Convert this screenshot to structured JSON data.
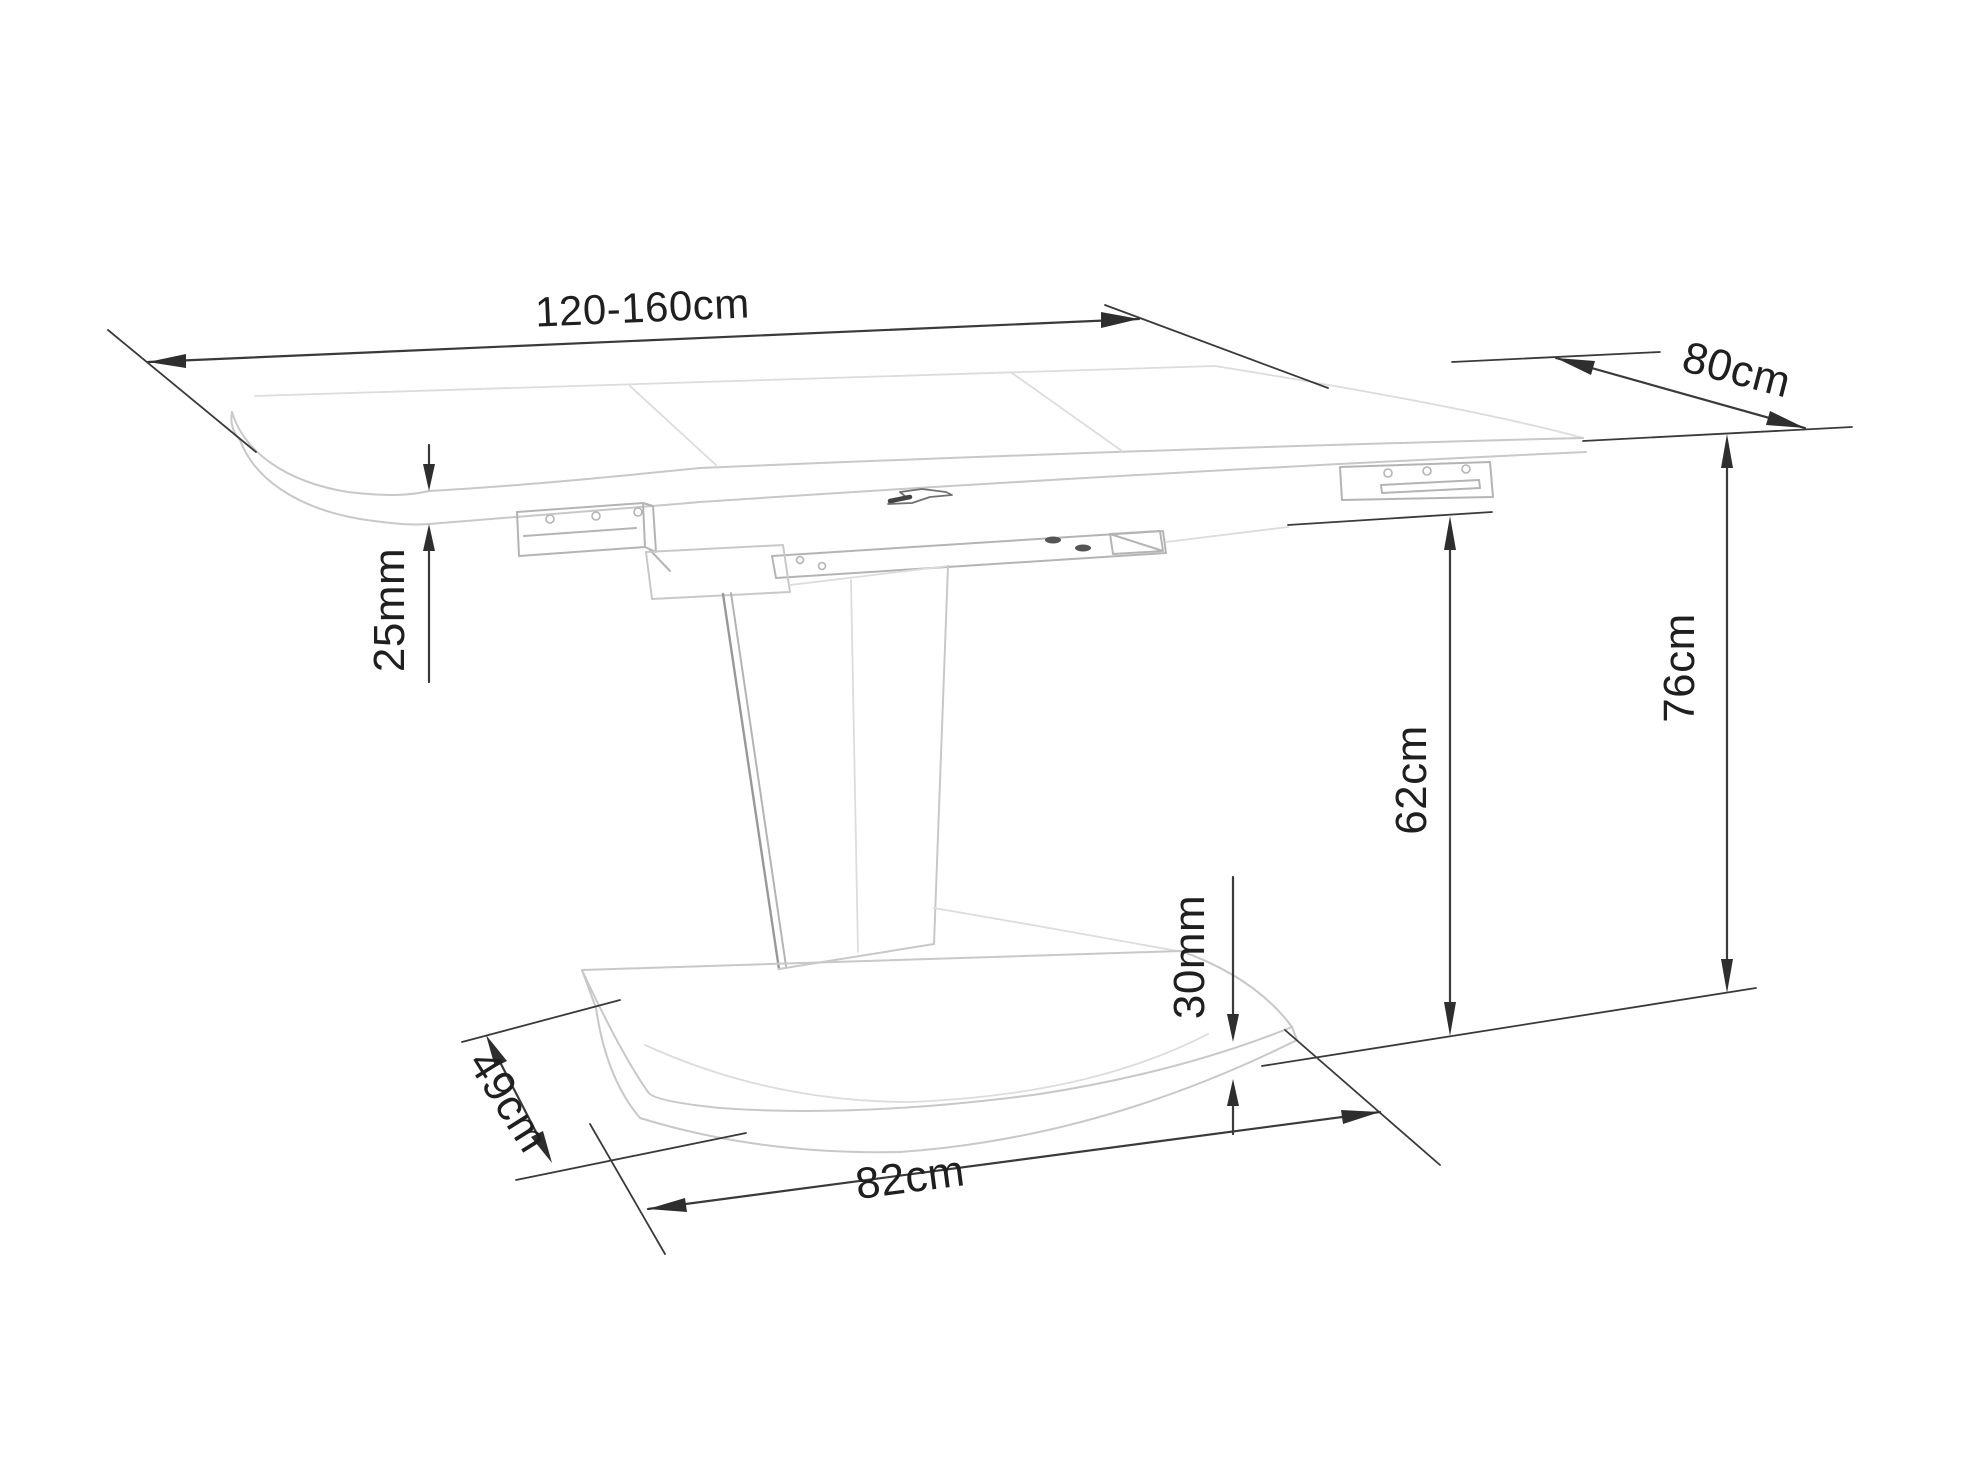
{
  "page": {
    "background_color": "#ffffff"
  },
  "diagram": {
    "subject": "extendable-pedestal-table-dimension-drawing",
    "style": {
      "dimension_line_color": "#3a3a3a",
      "structure_line_color": "#c8c8c8",
      "label_color": "#1f1f1f"
    },
    "dimensions": {
      "table_length": {
        "label": "120-160cm"
      },
      "table_depth": {
        "label": "80cm"
      },
      "top_thickness": {
        "label": "25mm"
      },
      "total_height": {
        "label": "76cm"
      },
      "clearance_height": {
        "label": "62cm"
      },
      "base_thickness": {
        "label": "30mm"
      },
      "base_depth": {
        "label": "49cm"
      },
      "base_width": {
        "label": "82cm"
      }
    }
  }
}
